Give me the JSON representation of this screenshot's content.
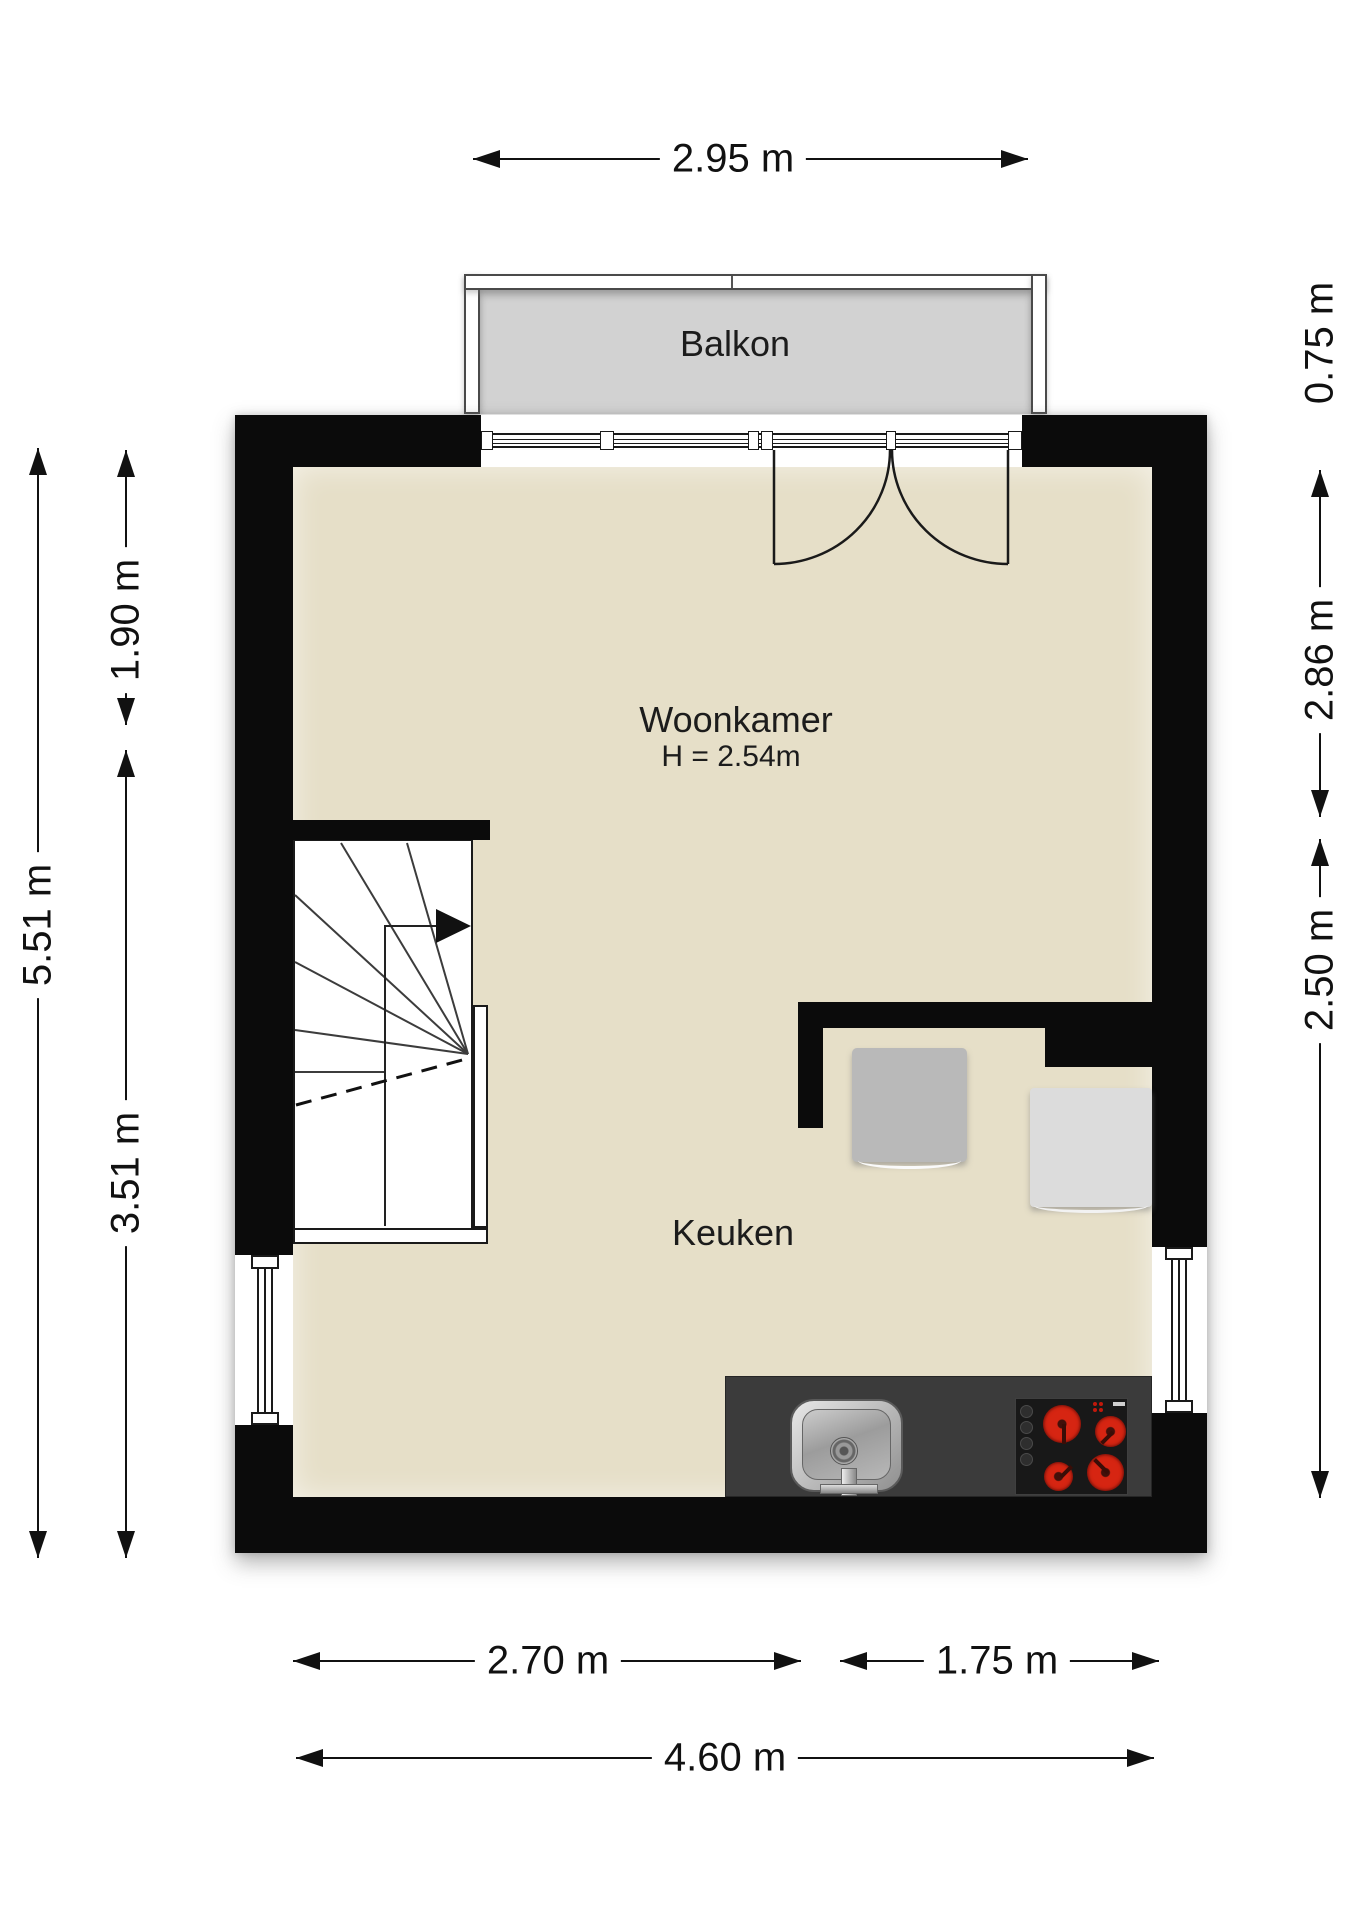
{
  "rooms": {
    "balcony_label": "Balkon",
    "living_label": "Woonkamer",
    "living_height": "H = 2.54m",
    "kitchen_label": "Keuken"
  },
  "dimensions": {
    "top_width": "2.95 m",
    "left_total": "5.51 m",
    "left_upper": "1.90 m",
    "left_lower": "3.51 m",
    "balcony_depth": "0.75 m",
    "right_upper": "2.86 m",
    "right_lower": "2.50 m",
    "bottom_left": "2.70 m",
    "bottom_right": "1.75 m",
    "bottom_total": "4.60 m"
  },
  "colors": {
    "wall": "#0b0b0b",
    "floor": "#e6dfc8",
    "balcony_floor": "#d2d2d2",
    "counter": "#3b3b3b",
    "stove": "#181818",
    "burner_red": "#d62512",
    "table_gray": "#b9b9b9",
    "appliance_gray": "#dcdcdc",
    "dimension_text": "#111111"
  },
  "fixtures": {
    "sink": "sink-icon",
    "stove": "stove-icon",
    "stair_direction": "stair-up-arrow-icon",
    "balcony_door": "double-door-icon"
  }
}
